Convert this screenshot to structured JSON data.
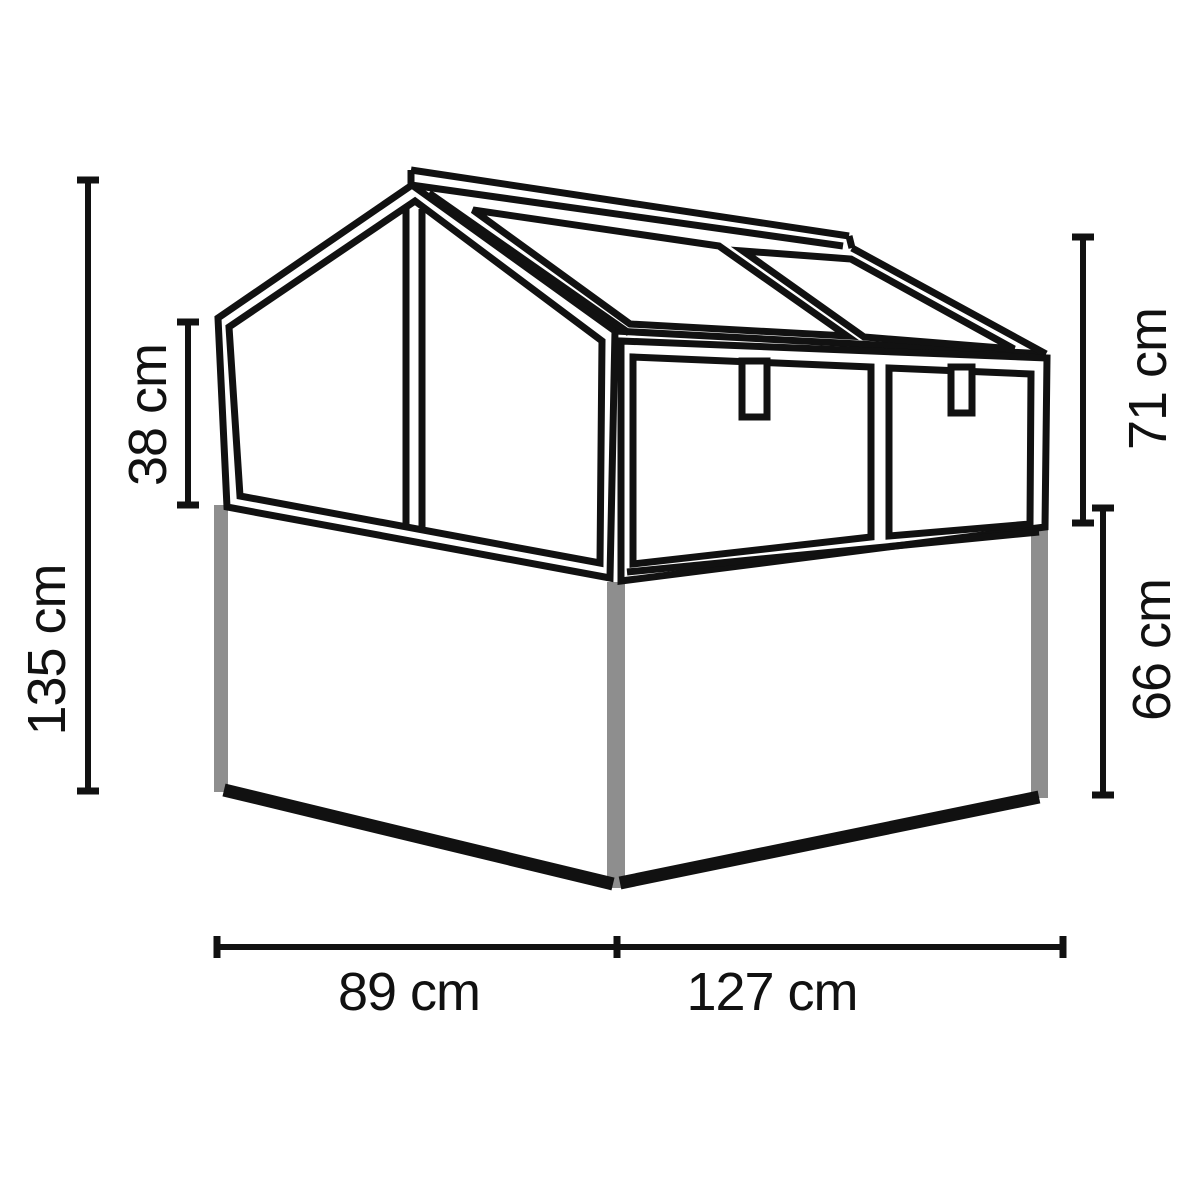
{
  "diagram": {
    "type": "product-dimension-drawing",
    "subject": "cold frame greenhouse on raised bed base",
    "unit": "cm",
    "colors": {
      "line": "#111111",
      "corner_post_gray": "#8e8e8e",
      "background": "#ffffff"
    },
    "dims": {
      "total_height": "135 cm",
      "side_glazing_height": "38 cm",
      "top_section_height": "71 cm",
      "base_height": "66 cm",
      "side_depth": "89 cm",
      "front_width": "127 cm"
    }
  }
}
